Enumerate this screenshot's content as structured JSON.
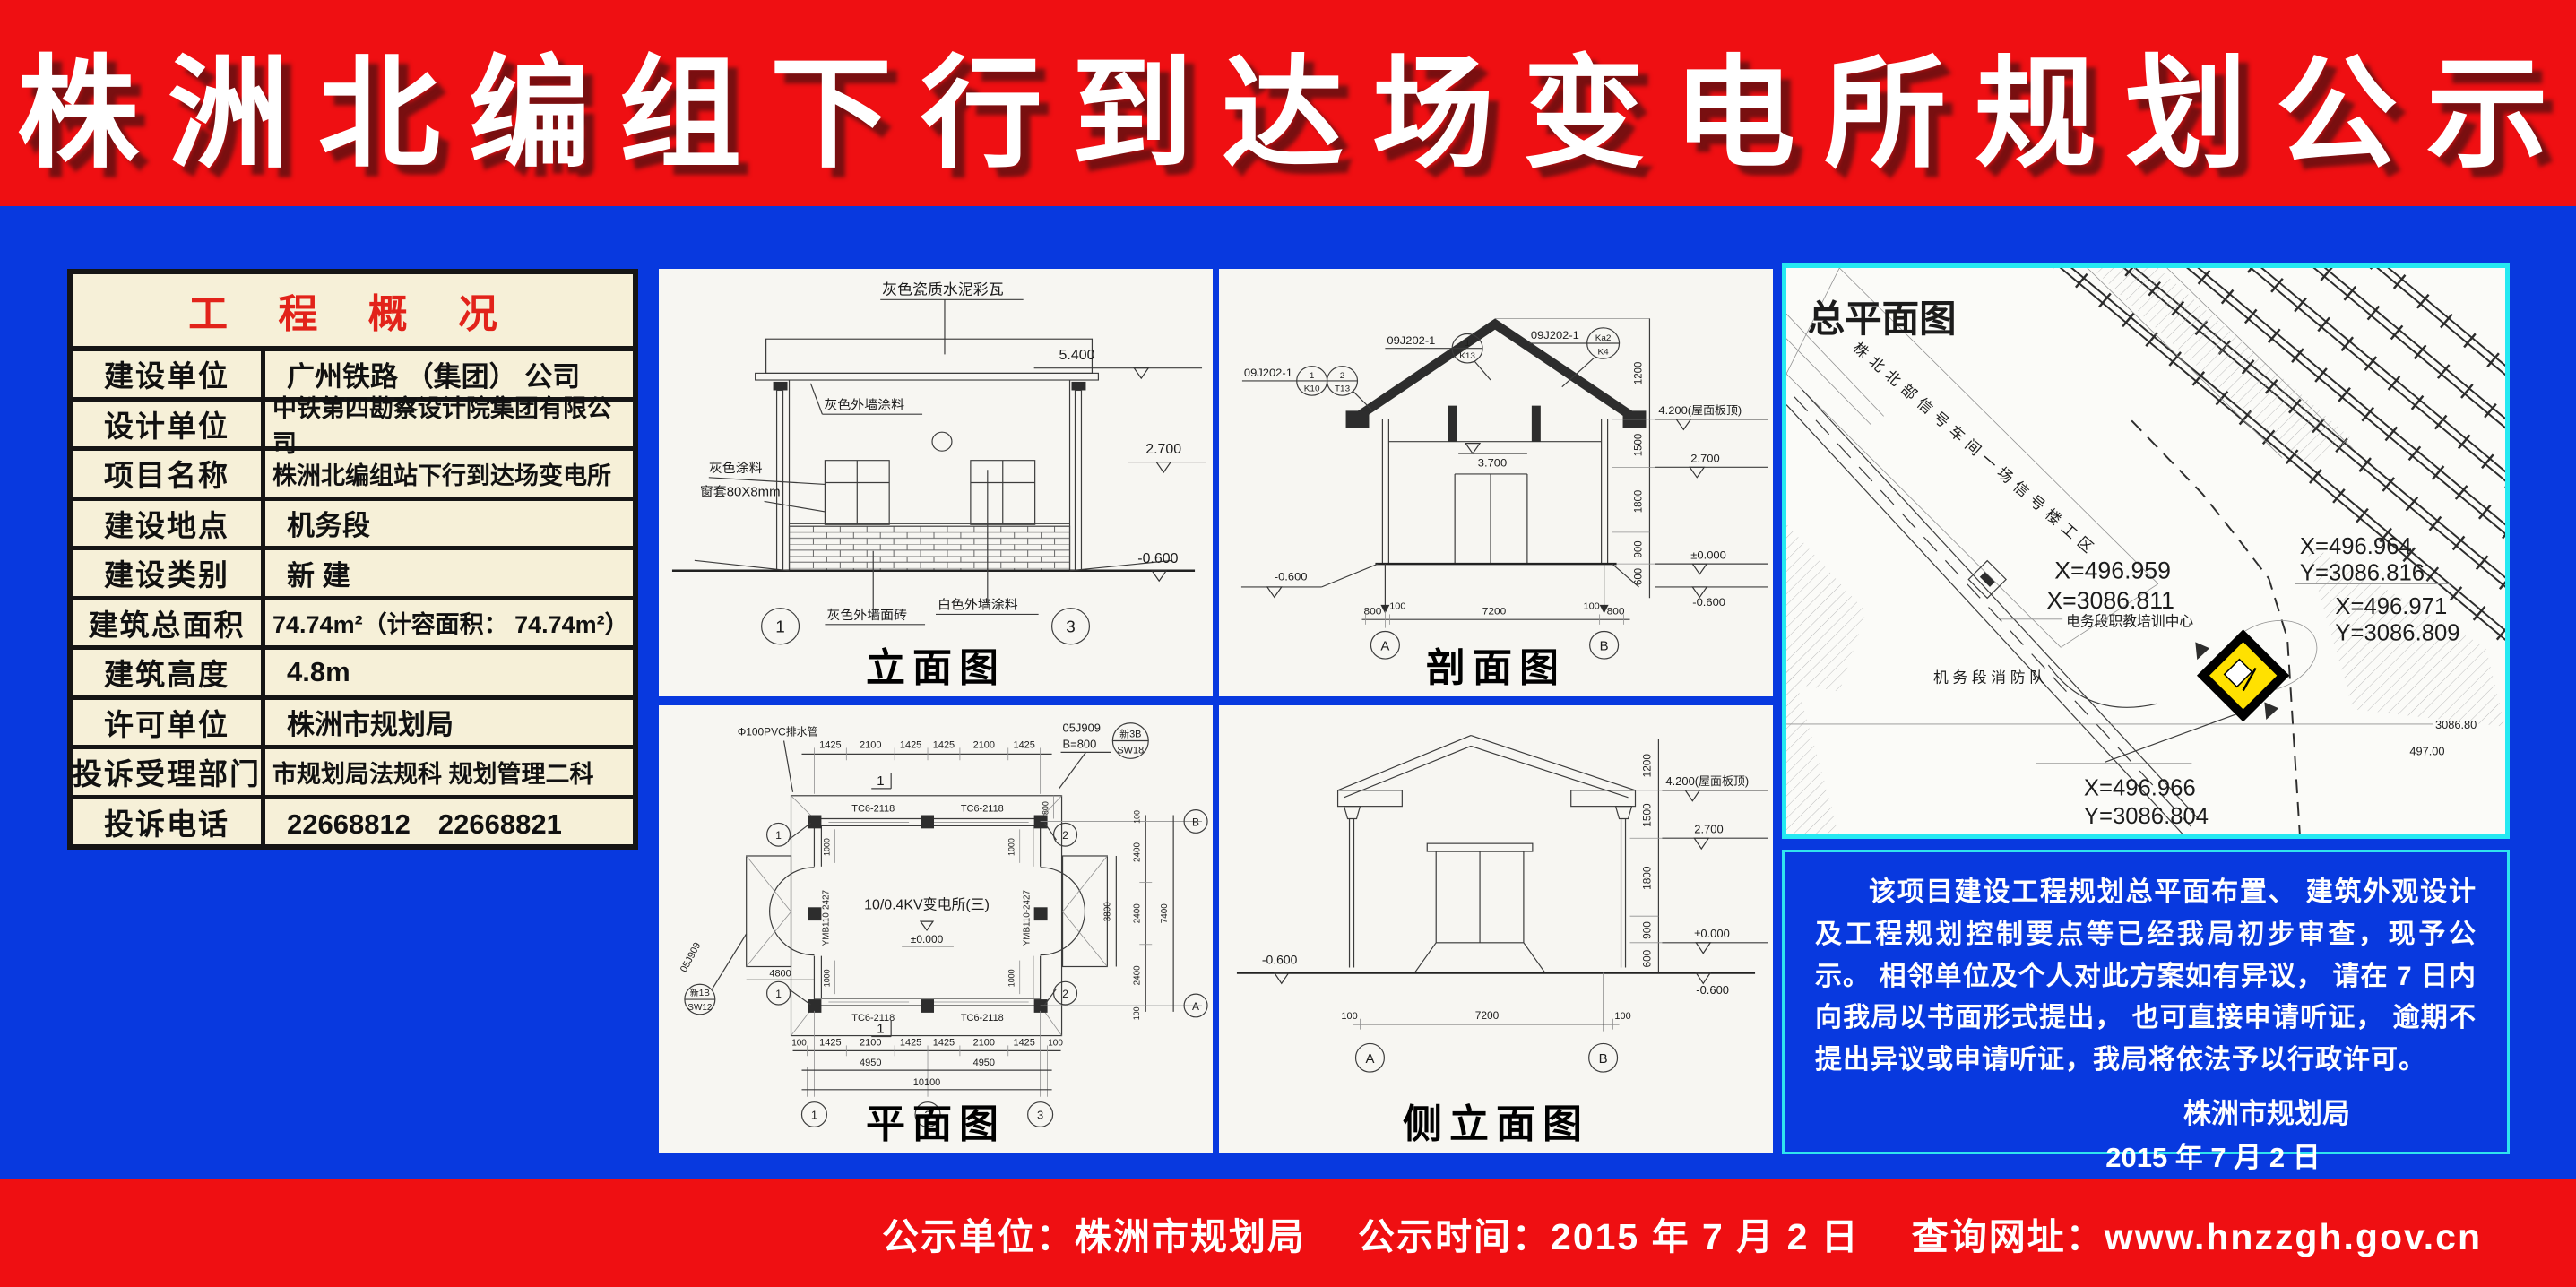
{
  "colors": {
    "banner_red": "#ef0f12",
    "body_blue": "#0839df",
    "table_cream": "#f6f0d8",
    "table_title_red": "#e2231a",
    "panel_border_cyan": "#25e9f2",
    "site_marker_yellow": "#ffe100",
    "text_white": "#ffffff"
  },
  "header": {
    "title": "株洲北编组下行到达场变电所规划公示"
  },
  "table": {
    "title": "工 程 概 况",
    "rows": [
      {
        "label": "建设单位",
        "value": "广州铁路 （集团） 公司"
      },
      {
        "label": "设计单位",
        "value": "中铁第四勘察设计院集团有限公司"
      },
      {
        "label": "项目名称",
        "value": "株洲北编组站下行到达场变电所"
      },
      {
        "label": "建设地点",
        "value": "机务段"
      },
      {
        "label": "建设类别",
        "value": "新 建"
      },
      {
        "label": "建筑总面积",
        "value": "74.74m²（计容面积： 74.74m²）"
      },
      {
        "label": "建筑高度",
        "value": "4.8m"
      },
      {
        "label": "许可单位",
        "value": "株洲市规划局"
      },
      {
        "label": "投诉受理部门",
        "value": "市规划局法规科 规划管理二科"
      },
      {
        "label": "投诉电话",
        "value": "22668812　22668821"
      }
    ]
  },
  "elev": {
    "title": "立面图",
    "roof_label": "灰色瓷质水泥彩瓦",
    "wall_label": "灰色外墙涂料",
    "paint_label": "灰色涂料",
    "frame_label": "窗套80X8mm",
    "brick_label": "灰色外墙面砖",
    "white_label": "白色外墙涂料",
    "lvl_roof": "5.400",
    "lvl_mid": "2.700",
    "lvl_ground": "-0.600",
    "axis_l": "1",
    "axis_r": "3"
  },
  "sect": {
    "title": "剖面图",
    "code": "09J202-1",
    "co_l_n1": "1",
    "co_l_d1": "K10",
    "co_l_n2": "2",
    "co_l_d2": "T13",
    "co_m_n": "1",
    "co_m_d": "K13",
    "co_r_n": "Ka2",
    "co_r_d": "K4",
    "lvl_roof": "4.200(屋面板顶)",
    "lvl_27": "2.700",
    "lvl_37": "3.700",
    "lvl_0": "±0.000",
    "lvl_m06": "-0.600",
    "dims_v": [
      "1200",
      "1500",
      "1800",
      "900",
      "600"
    ],
    "dims_b": [
      "800",
      "100",
      "7200",
      "100",
      "800"
    ],
    "axis_a": "A",
    "axis_b": "B"
  },
  "plan": {
    "title": "平面图",
    "dims_top": [
      "1425",
      "2100",
      "1425",
      "1425",
      "2100",
      "1425"
    ],
    "dims_bottom": [
      "100",
      "1425",
      "2100",
      "1425",
      "1425",
      "2100",
      "1425",
      "100"
    ],
    "dims_b2": [
      "4950",
      "4950"
    ],
    "dim_total": "10100",
    "dims_right": [
      "2400",
      "2400",
      "2400"
    ],
    "dim_100": "100",
    "dim_right_total": "7400",
    "dim_porch": "3800",
    "dim_left": "4800",
    "dim_1000": "1000",
    "dim_800": "800",
    "wall_label": "TC6-2118",
    "door_label": "YMB110-2427",
    "room_label": "10/0.4KV变电所(三)",
    "lvl_0": "±0.000",
    "ref_code": "05J909",
    "ref_b": "B=800",
    "ref_top_n": "新3B",
    "ref_top_d": "SW18",
    "ref_left_n": "新1B",
    "ref_left_d": "SW12",
    "pvc_label": "Φ100PVC排水管",
    "axis_1": "1",
    "axis_2": "2",
    "axis_3": "3",
    "axis_a": "A",
    "axis_b": "B",
    "sec_mark": "1"
  },
  "side": {
    "title": "侧立面图",
    "lvl_roof": "4.200(屋面板顶)",
    "lvl_27": "2.700",
    "lvl_0": "±0.000",
    "lvl_m06": "-0.600",
    "dims_v": [
      "1200",
      "1500",
      "1800",
      "900",
      "600"
    ],
    "dims_b": [
      "100",
      "7200",
      "100"
    ],
    "axis_a": "A",
    "axis_b": "B"
  },
  "site": {
    "title": "总平面图",
    "diag_label": "株北北部信号车间一场信号楼工区",
    "center_label": "电务段职教培训中心",
    "fire_label": "机 务 段 消 防 队",
    "coord1a": "X=496.959",
    "coord1b": "X=3086.811",
    "coord2a": "X=496.964",
    "coord2b": "Y=3086.816",
    "coord3a": "X=496.971",
    "coord3b": "Y=3086.809",
    "coord4a": "X=496.966",
    "coord4b": "Y=3086.804",
    "misc1": "3086.80",
    "misc2": "497.00"
  },
  "notice": {
    "body": "该项目建设工程规划总平面布置、 建筑外观设计及工程规划控制要点等已经我局初步审查，现予公示。 相邻单位及个人对此方案如有异议， 请在 7 日内向我局以书面形式提出， 也可直接申请听证， 逾期不提出异议或申请听证，我局将依法予以行政许可。",
    "signer": "株洲市规划局",
    "date": "2015 年 7 月 2 日"
  },
  "footer": {
    "unit_label": "公示单位：",
    "unit": "株洲市规划局",
    "time_label": "公示时间：",
    "time": "2015 年 7 月 2 日",
    "url_label": "查询网址：",
    "url": "www.hnzzgh.gov.cn"
  }
}
